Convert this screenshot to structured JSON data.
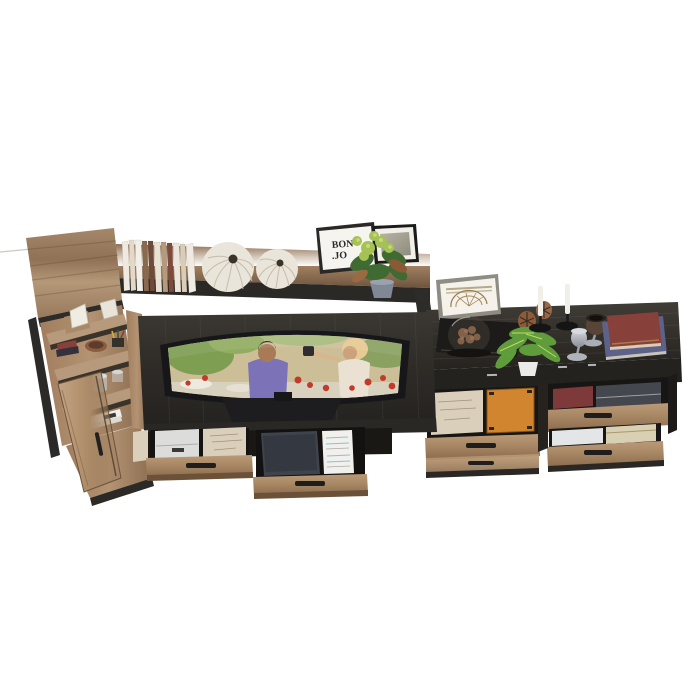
{
  "scene": {
    "title": "Rustic industrial entertainment-center wall unit, 3D product render on white background, viewed from a high front angle",
    "background_color": "#ffffff"
  },
  "frame_art": {
    "line1": "BON",
    "line2": ".JO"
  },
  "palette": {
    "wood_light": "#b29071",
    "wood_mid": "#9c7a5c",
    "wood_deep": "#7c5f46",
    "charcoal": "#34312c",
    "charcoal_dark": "#232120",
    "metal": "#2b2a28",
    "decor_white": "#eae5da",
    "cream": "#d9cfba",
    "paper_white": "#f1f0ed",
    "orange_folder": "#d2852f",
    "red_book": "#87413a",
    "dark_red_book": "#7e3a3a",
    "blue_book": "#5c6288",
    "leaf_green": "#5f9c3b",
    "leaf_dark": "#3f6b33",
    "leaf_light": "#a6c254",
    "screen_tan": "#ccbe97",
    "figure_purple": "#7b72b8",
    "dress_white": "#ebe1d3",
    "tomato": "#c23b2a",
    "laptop_gray": "#3f434b",
    "candle_white": "#f1efe9",
    "silver": "#aeb3bb",
    "copper": "#9a6a4a",
    "pot_gray": "#7f8894",
    "glass": "#c7d2d8"
  },
  "left_cabinet": {
    "label": "tall open display cabinet with rustic-oak top box",
    "items": [
      "white geometric ornament",
      "faceted white vase",
      "red books",
      "copper bowl",
      "pencil cup",
      "drinking glass",
      "glass jar",
      "stacked papers",
      "open wooden door with metal handle"
    ]
  },
  "bridge_shelf": {
    "label": "long bridge shelf over TV",
    "items": [
      "row of books",
      "two round white lattice vases",
      "white picture frame with BON.JO print",
      "black photo frame",
      "green plant in grey pot"
    ]
  },
  "tv_stand": {
    "label": "charcoal TV console with curved television",
    "screen": "movie scene: man in purple shirt and woman in white dress at an outdoor market with tomatoes and greenery",
    "drawers": [
      "open drawer with white box and handwritten cream folder",
      "open drawer with dark laptop case and printed white cards"
    ]
  },
  "right_cabinet": {
    "label": "charcoal-top sideboard with rustic drawers",
    "top_items": [
      "framed antique semicircle chart",
      "glass cloche with dried copper flowers on black book",
      "two pinecones",
      "green plant in white pot",
      "two white taper candles on black holders",
      "silver goblet",
      "bronze goblet",
      "stacked red and blue books"
    ],
    "drawer_items": [
      "cream document file",
      "orange folder",
      "dark red book",
      "grey folders",
      "white tray",
      "cream box"
    ]
  }
}
